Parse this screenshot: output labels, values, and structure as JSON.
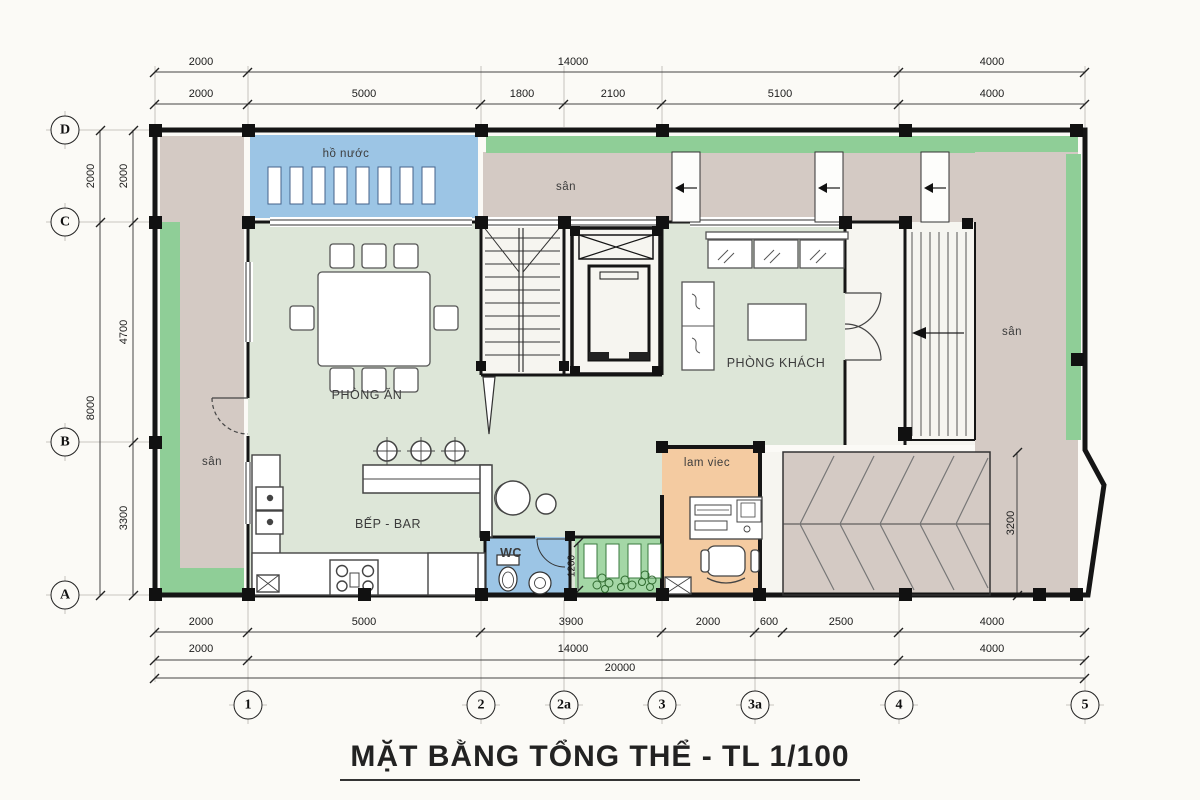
{
  "title": "MẶT BẰNG TỔNG THỂ  - TL 1/100",
  "axes": {
    "rows": [
      "D",
      "C",
      "B",
      "A"
    ],
    "cols": [
      "1",
      "2",
      "2a",
      "3",
      "3a",
      "4",
      "5"
    ]
  },
  "dimensions": {
    "top_outer": [
      "2000",
      "14000",
      "4000"
    ],
    "top_inner": [
      "2000",
      "5000",
      "1800",
      "2100",
      "5100",
      "4000"
    ],
    "left_outer": [
      "2000",
      "8000"
    ],
    "left_inner": [
      "2000",
      "4700",
      "3300"
    ],
    "bottom_inner": [
      "2000",
      "5000",
      "3900",
      "2000",
      "600",
      "2500",
      "4000"
    ],
    "bottom_mid": [
      "2000",
      "14000",
      "4000"
    ],
    "bottom_total": "20000",
    "right_court_height": "3200",
    "garden_width": "1200"
  },
  "rooms": {
    "water_tank": "hồ nước",
    "yard_top": "sân",
    "yard_left": "sân",
    "yard_right": "sân",
    "dining": "PHÒNG ĂN",
    "living": "PHÒNG KHÁCH",
    "kitchen_bar": "BẾP - BAR",
    "wc": "WC",
    "study": "lam viec"
  },
  "colors": {
    "floor": "#dde6d8",
    "yard": "#d4cac4",
    "water": "#9cc5e5",
    "greenery": "#8fce97",
    "garden": "#a4d7a6",
    "study": "#f4cba1",
    "porch": "#f6f5f0",
    "line": "#151515"
  }
}
